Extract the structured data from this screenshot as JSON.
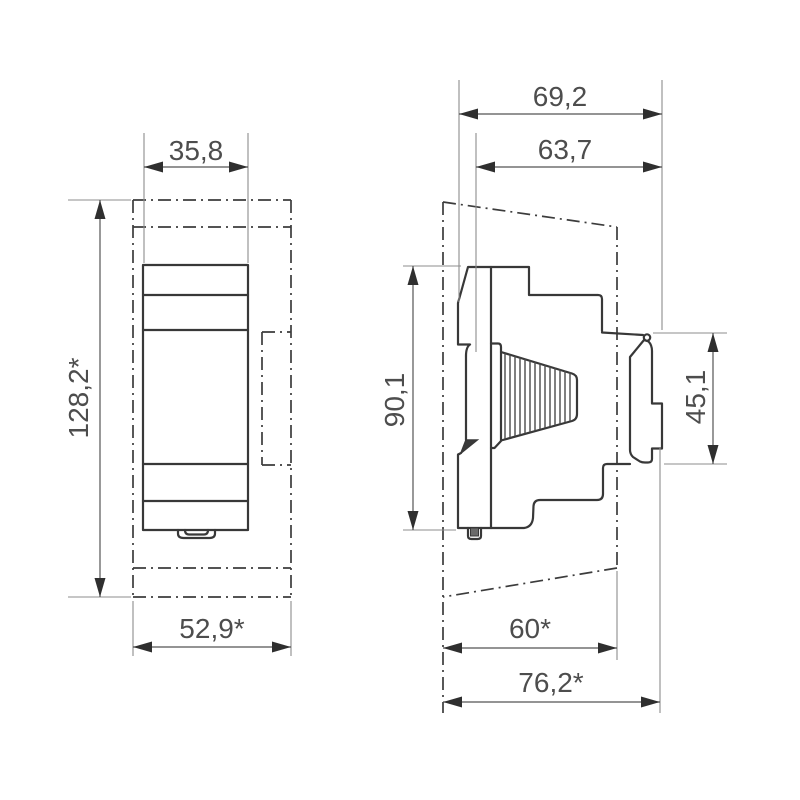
{
  "drawing": {
    "kind": "technical-dimension-drawing",
    "background": "#ffffff",
    "line_color": "#383838",
    "dim_text_color": "#4d4d4d",
    "views": {
      "front": {
        "name": "front-view",
        "dimensions": [
          {
            "id": "module-width",
            "label": "35,8"
          },
          {
            "id": "overall-height",
            "label": "128,2*"
          },
          {
            "id": "overall-width",
            "label": "52,9*"
          }
        ]
      },
      "side": {
        "name": "side-view",
        "dimensions": [
          {
            "id": "overall-depth",
            "label": "69,2"
          },
          {
            "id": "front-depth",
            "label": "63,7"
          },
          {
            "id": "body-height",
            "label": "90,1"
          },
          {
            "id": "front-panel-height",
            "label": "45,1"
          },
          {
            "id": "recess-depth",
            "label": "60*"
          },
          {
            "id": "total-depth",
            "label": "76,2*"
          }
        ]
      }
    }
  }
}
